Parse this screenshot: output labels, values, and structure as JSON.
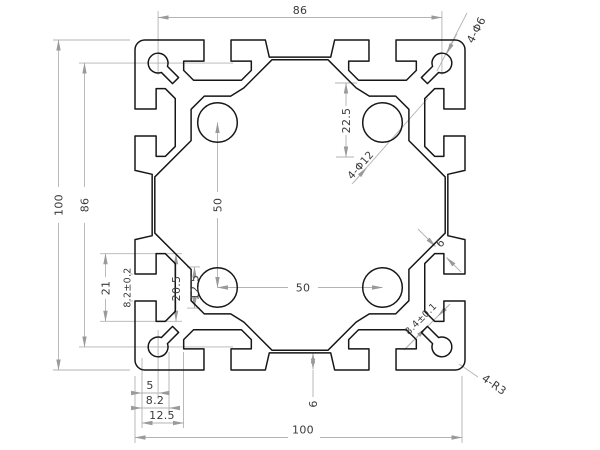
{
  "drawing": {
    "background": "#ffffff",
    "outline_color": "#161616",
    "dimension_line_color": "#b3b3b3",
    "dimension_text_color": "#3a3a3a",
    "annotations": {
      "top_hole_spacing": "86",
      "corner_holes_label": "4-Φ6",
      "overall_height": "100",
      "side_hole_spacing": "86",
      "slot_height_21": "21",
      "slot_opening_82": "8.2±0.2",
      "slot_cavity_205": "20.5",
      "slot_depth_125": "12.5",
      "bore_spacing_vertical": "50",
      "bore_offset_225": "22.5",
      "center_bores_label": "4-Φ12",
      "web_thickness_6": "6",
      "bore_spacing_horizontal": "50",
      "slot_width_84": "8.4±0.1",
      "corner_radius_label": "4-R3",
      "bottom_wall_6": "6",
      "stack_5": "5",
      "stack_82": "8.2",
      "stack_125": "12.5",
      "overall_width": "100"
    }
  }
}
